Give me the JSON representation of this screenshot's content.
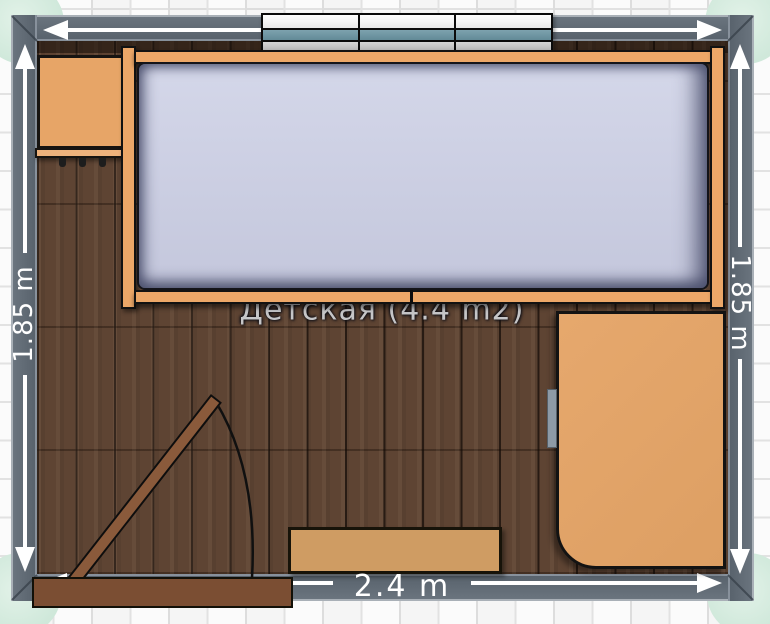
{
  "labels": {
    "room": "Детская (4.4 m2)",
    "dim_left": "1.85 m",
    "dim_right": "1.85 m",
    "dim_bottom": "2.4 m"
  },
  "furniture": {
    "bed": "bed with mattress",
    "wall_shelf": "three-section wall shelf",
    "coat_cabinet": "wall cabinet with hooks",
    "wardrobe": "wardrobe with handle",
    "low_shelf": "low shelf",
    "door": "door with swing arc"
  },
  "colors": {
    "wall": "#5d6770",
    "floor_wood": "#5e4433",
    "furniture_wood": "#eca768",
    "mattress": "#cdd0e3",
    "door_wood": "#8a5a3b",
    "threshold_wood": "#7b4e33",
    "corner_marker": "#d7ecdf",
    "shelf_accent_teal": "#6e95a3",
    "dimension_text": "#ffffff",
    "room_label_text": "#c6c6c8"
  }
}
